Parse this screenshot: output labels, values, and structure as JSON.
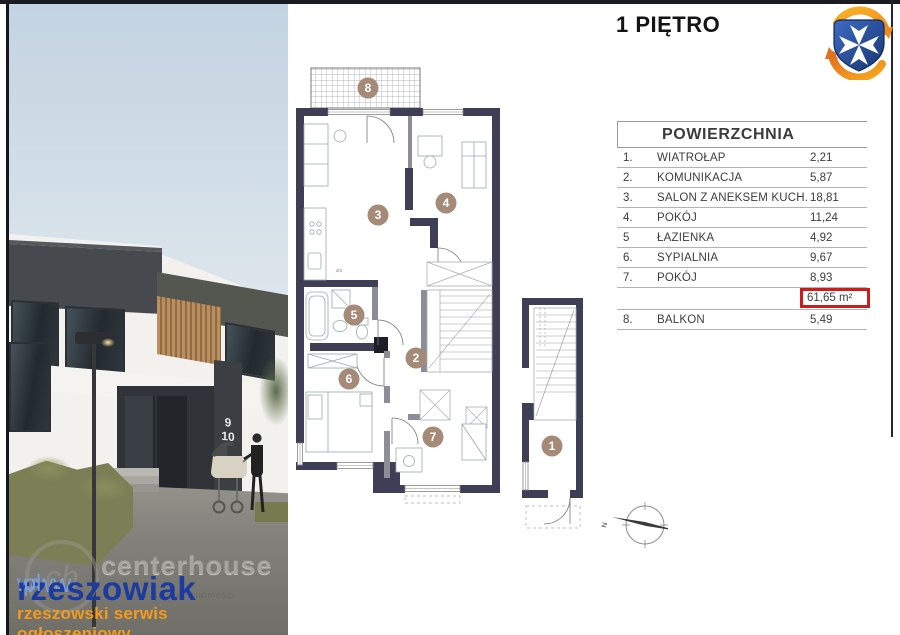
{
  "header": {
    "title": "1 PIĘTRO"
  },
  "logo": {
    "name": "herb-rzeszowa",
    "shield_color": "#2b56a8",
    "cross_color": "#ffffff",
    "arrow_color": "#f6a21d"
  },
  "area_table": {
    "title": "POWIERZCHNIA",
    "rows": [
      {
        "no": "1.",
        "name": "WIATROŁAP",
        "area": "2,21"
      },
      {
        "no": "2.",
        "name": "KOMUNIKACJA",
        "area": "5,87"
      },
      {
        "no": "3.",
        "name": "SALON Z ANEKSEM KUCH.",
        "area": "18,81"
      },
      {
        "no": "4.",
        "name": "POKÓJ",
        "area": "11,24"
      },
      {
        "no": "5",
        "name": "ŁAZIENKA",
        "area": "4,92"
      },
      {
        "no": "6.",
        "name": "SYPIALNIA",
        "area": "9,67"
      },
      {
        "no": "7.",
        "name": "POKÓJ",
        "area": "8,93"
      }
    ],
    "total_area": "61,65 m²",
    "balcony_row": {
      "no": "8.",
      "name": "BALKON",
      "area": "5,49"
    },
    "accent_red": "#cc1d1d"
  },
  "floorplan": {
    "room_labels": {
      "r1": "1",
      "r2": "2",
      "r3": "3",
      "r4": "4",
      "r5": "5",
      "r6": "6",
      "r7": "7",
      "r8": "8"
    },
    "kitchen_note": "zm",
    "compass_north": "N",
    "wall_color": "#3e3e57",
    "marker_color": "#a48a77"
  },
  "photo": {
    "house_numbers": {
      "top": "9",
      "bottom": "10"
    },
    "watermark": {
      "prefix": "www",
      "brand": "rzeszowiak",
      "suffix": ".pl",
      "tagline": "rzeszowski serwis ogłoszeniowy",
      "embossed_brand": "centerhouse",
      "embossed_subtitle": "agencja nieruchomości",
      "embossed_monogram": "ch",
      "brand_blue": "#1c3ba0",
      "light_blue": "#7e9ed6",
      "orange": "#f59b17"
    }
  }
}
